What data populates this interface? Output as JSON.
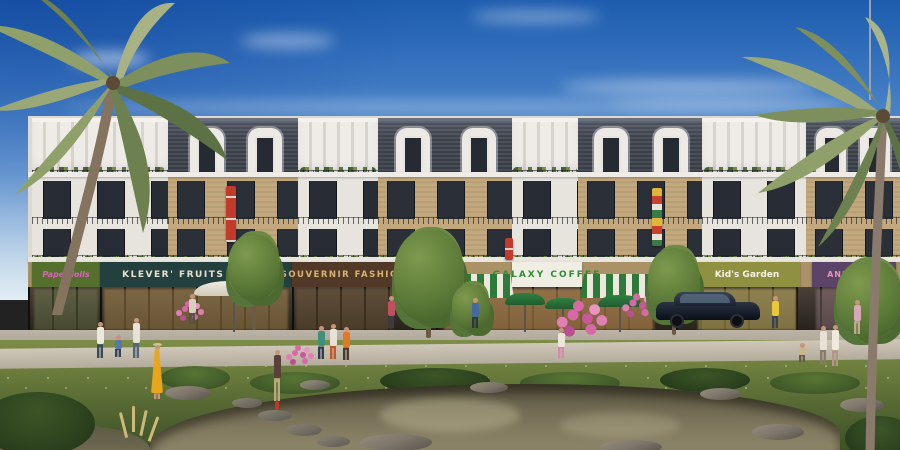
{
  "scene": {
    "type": "architectural-rendering",
    "setting": "Row of four-storey European-style shophouses with mansard slate roofs behind a landscaped park with a pond, stepping stones, palm trees and pedestrians",
    "sky": "clear blue with wispy clouds",
    "palette": {
      "sky_top": "#1d5cae",
      "sky_horizon": "#e2edf4",
      "roof_slate": "#424751",
      "facade_white": "#e7e4de",
      "facade_brick": "#c2a87c",
      "awning_green": "#2d7a3b",
      "grass": "#66783a",
      "pond_water": "#6e6850",
      "path": "#c6beb0",
      "car_color": "#141a26",
      "flower_pink": "#d76aa6",
      "yellow_dress": "#e8a51e"
    }
  },
  "storefronts": [
    {
      "name": "Paperdolls",
      "sign_bg": "#55702d",
      "text_color": "#e060c0"
    },
    {
      "name": "KLEVER' FRUITS STORE",
      "sign_bg": "#24403e",
      "text_color": "#e7e1d1"
    },
    {
      "name": "SOUVERNIR FASHION",
      "sign_bg": "#503a27",
      "text_color": "#d6b273"
    },
    {
      "name": "GALAXY COFFEE",
      "sign_bg": "#f0ede3",
      "text_color": "#2e8b3a"
    },
    {
      "name": "Kid's Garden",
      "sign_bg": "#8f9040",
      "text_color": "#f6f3e9"
    },
    {
      "name": "AN'S NAIL",
      "sign_bg": "#5c4468",
      "text_color": "#e890b8"
    }
  ],
  "decor": {
    "vertical_banners": [
      "red banner sign",
      "multicolor banner sign",
      "small red banner"
    ],
    "vehicle": "dark SUV parked at curb",
    "umbrellas": [
      "white cafe umbrella",
      "three green coffee-shop umbrellas"
    ]
  }
}
